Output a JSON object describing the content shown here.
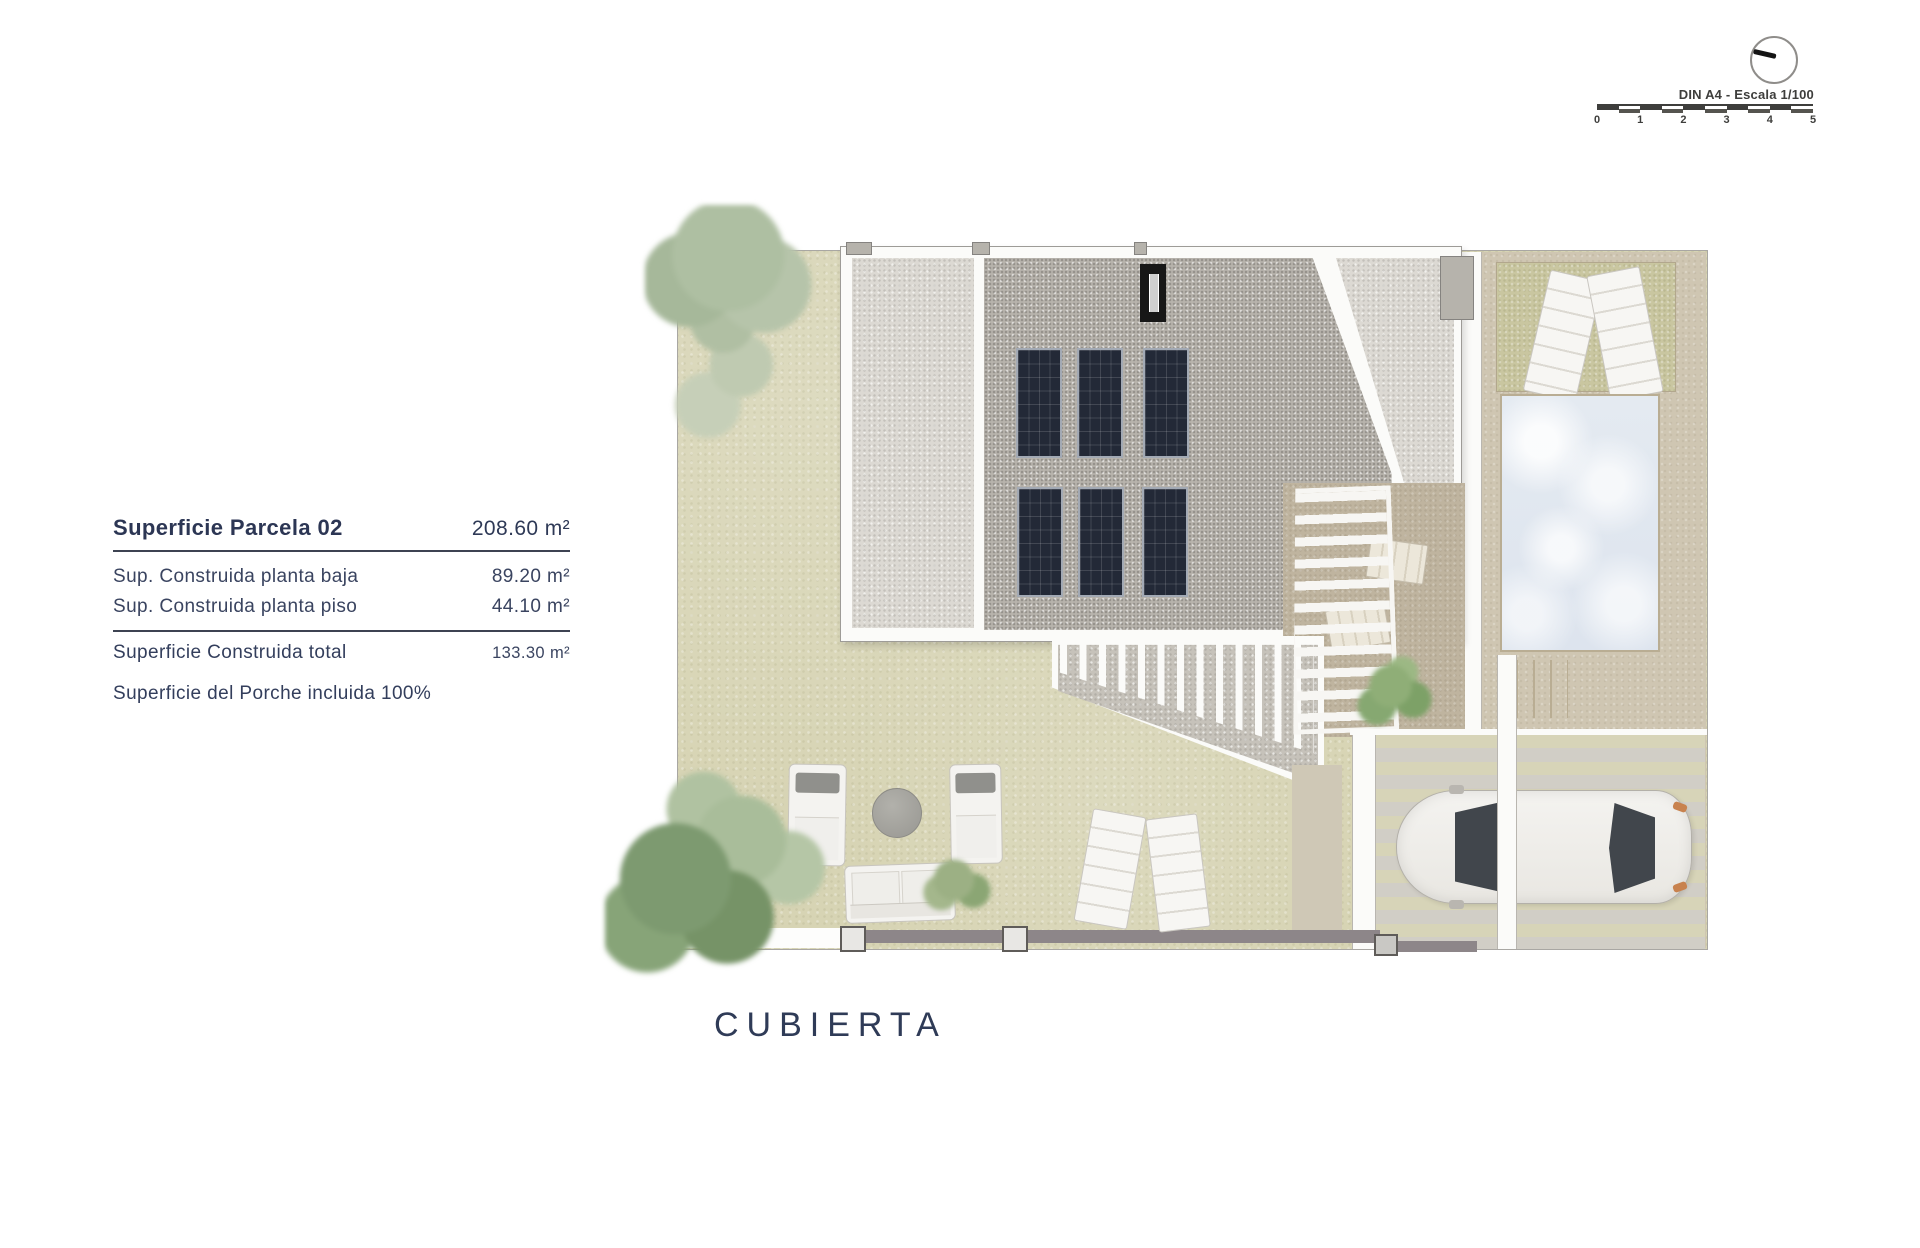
{
  "info_table": {
    "title": {
      "label": "Superficie Parcela 02",
      "value": "208.60 m²"
    },
    "rows": [
      {
        "label": "Sup. Construida planta baja",
        "value": "89.20 m²"
      },
      {
        "label": "Sup. Construida planta piso",
        "value": "44.10 m²"
      }
    ],
    "total": {
      "label": "Superficie Construida total",
      "value": "133.30 m²"
    },
    "note": "Superficie del Porche incluida 100%",
    "text_color": "#2e3956"
  },
  "caption": "CUBIERTA",
  "scalebar": {
    "label": "DIN A4 - Escala 1/100",
    "ticks": [
      "0",
      "1",
      "2",
      "3",
      "4",
      "5"
    ],
    "compass_icon": "compass-circle-with-needle"
  },
  "plan": {
    "type": "roof-plan",
    "solar_panels": 6,
    "colors": {
      "lawn": "#d7d4b4",
      "grass_patch": "#c9c6a0",
      "gravel_light": "#dcd9d3",
      "gravel_dark": "#b7b3ac",
      "roof_white": "#fbfbf9",
      "deck": "#cfc6b2",
      "terrace": "#bfb49f",
      "pool_water": "#e4eaf1",
      "pool_border": "#b9ad93",
      "solar_panel": "#232937",
      "chimney": "#171717",
      "fence": "#8d8689",
      "car_body": "#f2f1ee",
      "tree_dark": "#7d9a70",
      "tree_light": "#b2c1a6"
    }
  }
}
